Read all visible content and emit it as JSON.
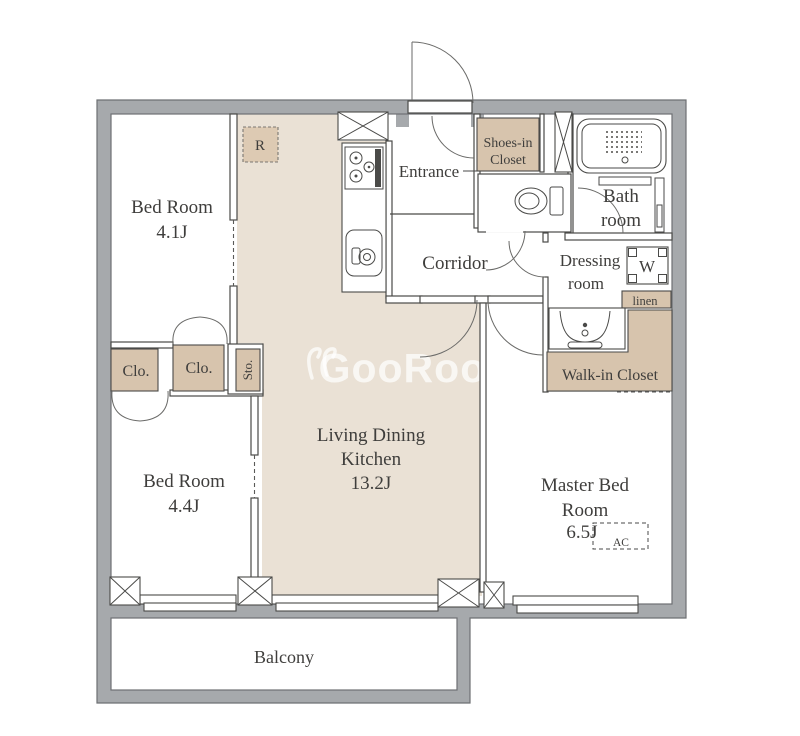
{
  "plan": {
    "title": "2LDK apartment floor plan",
    "rooms": {
      "bedroom1": {
        "name": "Bed Room",
        "size": "4.1J"
      },
      "bedroom2": {
        "name": "Bed Room",
        "size": "4.4J"
      },
      "ldk": {
        "name_line1": "Living Dining",
        "name_line2": "Kitchen",
        "size": "13.2J"
      },
      "master": {
        "name_line1": "Master Bed",
        "name_line2": "Room",
        "size": "6.5J"
      },
      "entrance": {
        "name": "Entrance"
      },
      "corridor": {
        "name": "Corridor"
      },
      "bath": {
        "name_line1": "Bath",
        "name_line2": "room"
      },
      "dressing": {
        "name_line1": "Dressing",
        "name_line2": "room"
      },
      "balcony": {
        "name": "Balcony"
      }
    },
    "storage": {
      "shoes_closet": {
        "line1": "Shoes-in",
        "line2": "Closet"
      },
      "walk_in_closet": {
        "label": "Walk-in Closet"
      },
      "linen": {
        "label": "linen"
      },
      "closet1": {
        "label": "Clo."
      },
      "closet2": {
        "label": "Clo."
      },
      "storage": {
        "label": "Sto."
      }
    },
    "appliances": {
      "refrigerator": {
        "label": "R"
      },
      "washer": {
        "label": "W"
      },
      "air_conditioner": {
        "label": "AC"
      }
    },
    "watermark": {
      "text": "GooRooM"
    },
    "colors": {
      "wall_gray": "#a6a9ac",
      "floor_beige": "#eae1d5",
      "closet_beige": "#d7c4ad",
      "line": "#4a4a48",
      "text": "#3f3e3c"
    }
  }
}
